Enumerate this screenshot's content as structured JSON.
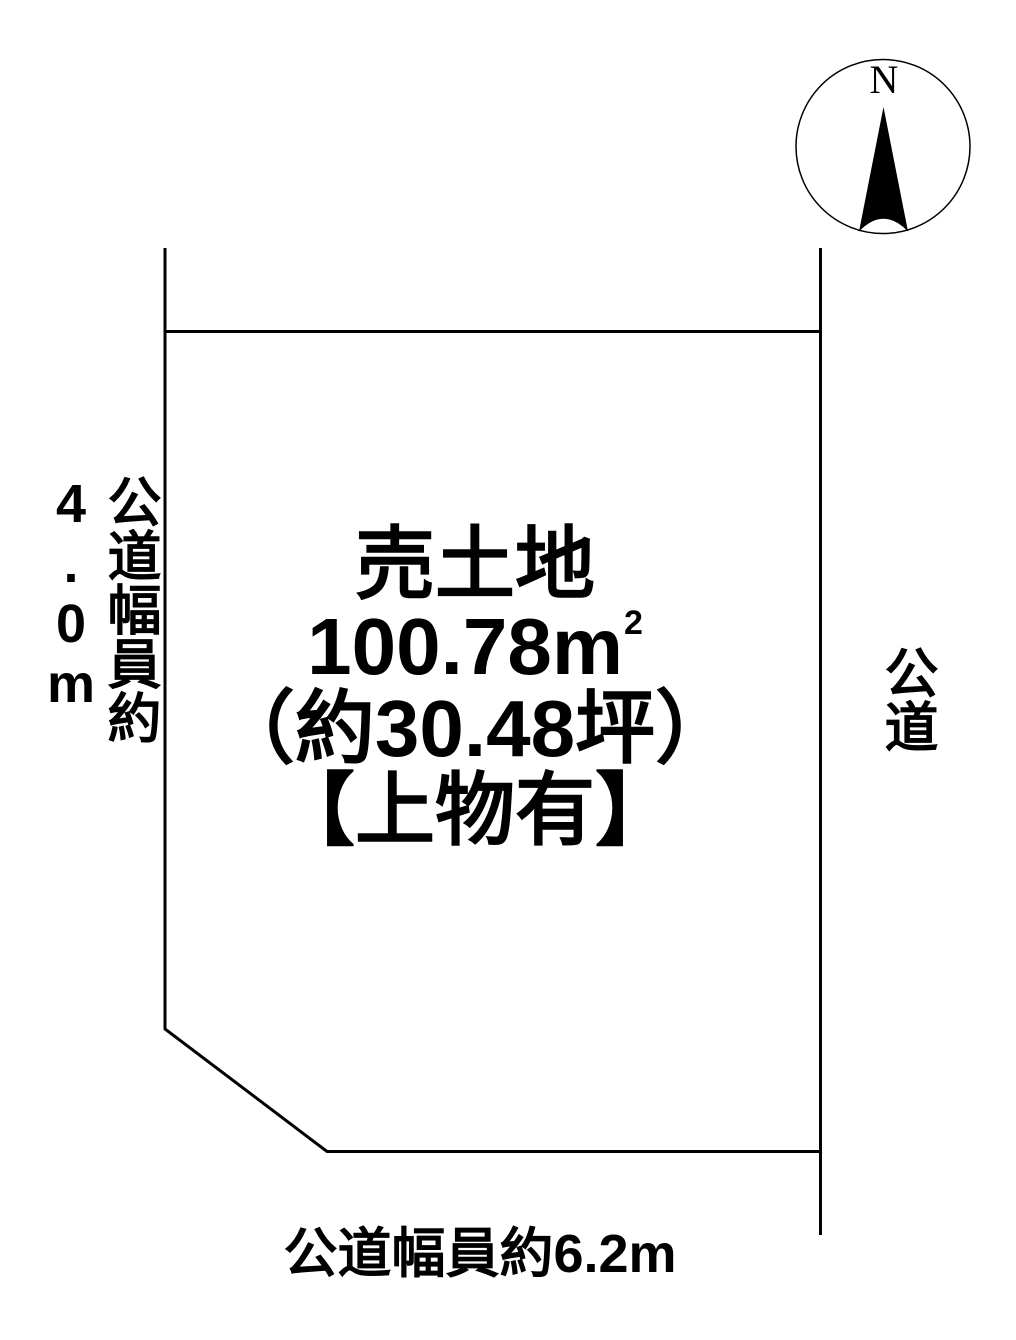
{
  "compass": {
    "north_label": "N"
  },
  "parcel": {
    "title": "売土地",
    "area_value": "100.78m",
    "area_superscript": "2",
    "area_tsubo": "（約30.48坪）",
    "note": "【上物有】"
  },
  "roads": {
    "west_label": "公道幅員約4.0m",
    "east_label": "公道",
    "south_label": "公道幅員約6.2m"
  },
  "colors": {
    "line": "#000000",
    "text": "#000000",
    "background": "#ffffff"
  }
}
